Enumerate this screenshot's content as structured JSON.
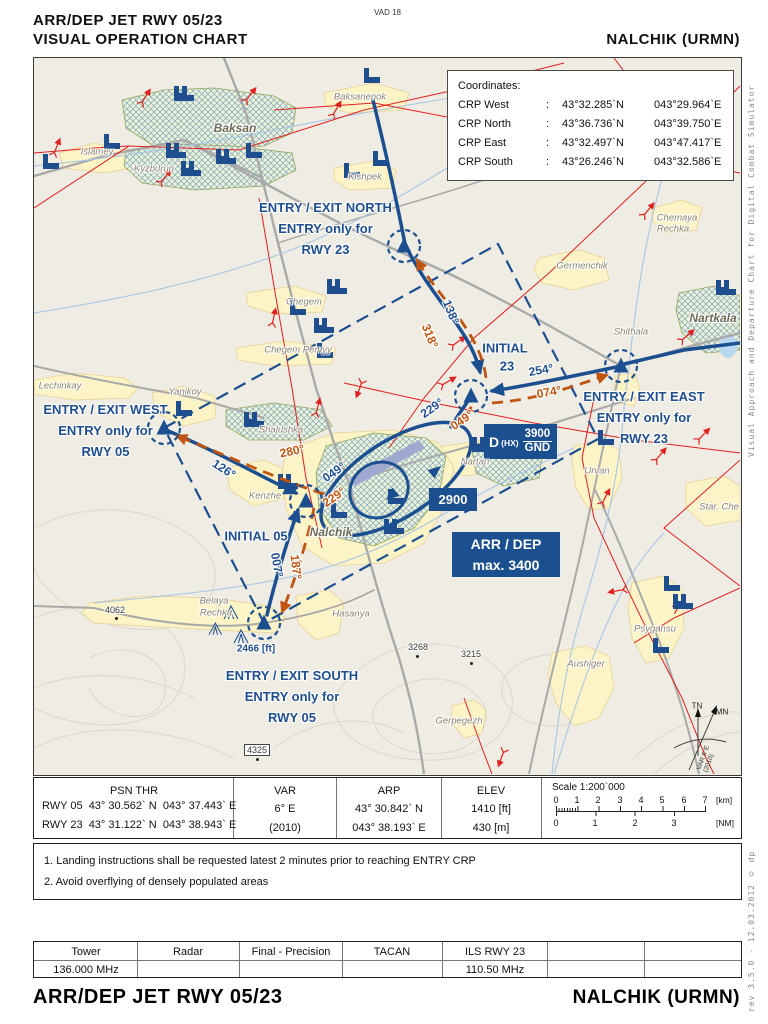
{
  "header": {
    "title": "ARR/DEP  JET  RWY  05/23",
    "subtitle": "VISUAL  OPERATION  CHART",
    "chart_code": "VAD 18",
    "airport": "NALCHIK (URMN)"
  },
  "footer": {
    "title": "ARR/DEP  JET  RWY  05/23",
    "airport": "NALCHIK (URMN)"
  },
  "margin": {
    "right_top": "Visual Approach and Departure Chart for Digital Combat Simulator",
    "right_bottom": "rev 3.5.0  -  12.03.2012 © dp"
  },
  "coordinates_box": {
    "title": "Coordinates:",
    "rows": [
      {
        "label": "CRP West",
        "sep": ":",
        "lat": "43°32.285`N",
        "lon": "043°29.964`E"
      },
      {
        "label": "CRP North",
        "sep": ":",
        "lat": "43°36.736`N",
        "lon": "043°39.750`E"
      },
      {
        "label": "CRP East",
        "sep": ":",
        "lat": "43°32.497`N",
        "lon": "043°47.417`E"
      },
      {
        "label": "CRP South",
        "sep": ":",
        "lat": "43°26.246`N",
        "lon": "043°32.586`E"
      }
    ]
  },
  "entry_labels": {
    "north": {
      "l1": "ENTRY / EXIT NORTH",
      "l2": "ENTRY only for",
      "l3": "RWY 23"
    },
    "east": {
      "l1": "ENTRY / EXIT EAST",
      "l2": "ENTRY only for",
      "l3": "RWY 23"
    },
    "west": {
      "l1": "ENTRY / EXIT WEST",
      "l2": "ENTRY only for",
      "l3": "RWY 05"
    },
    "south": {
      "l1": "ENTRY / EXIT SOUTH",
      "l2": "ENTRY only for",
      "l3": "RWY 05"
    },
    "initial23_l1": "INITIAL",
    "initial23_l2": "23",
    "initial05": "INITIAL 05"
  },
  "courses": {
    "c138": "138°",
    "c318": "318°",
    "c254": "254°",
    "c074": "074°",
    "c229": "229°",
    "c049": "049°",
    "c126": "126°",
    "c280": "280°",
    "c007": "007°",
    "c187": "187°"
  },
  "alt_boxes": {
    "danger_d": "D",
    "danger_hx": "(HX)",
    "danger_top": "3900",
    "danger_bottom": "GND",
    "circuit_alt": "2900",
    "arrdep_l1": "ARR / DEP",
    "arrdep_l2": "max. 3400"
  },
  "places": {
    "baksan": "Baksan",
    "islamey": "Islamey",
    "kyzburun": "Kyzburun",
    "baksanenok": "Baksanenok",
    "kishpek": "Kishpek",
    "chemaya_1": "Chemaya",
    "chemaya_2": "Rechka",
    "germenchik": "Germenchik",
    "nartkala": "Nartkala",
    "shithala": "Shithala",
    "chegem": "Chegem",
    "chegem_pervyy": "Chegem Pervyy",
    "lechinkay": "Lechinkay",
    "yanikoy": "Yanikoy",
    "shalushka": "Shalushka",
    "kenzhe": "Kenzhe",
    "nalchik": "Nalchik",
    "nartan": "Nartan",
    "urvan": "Urvan",
    "star_che": "Star. Che",
    "belaya_1": "Belaya",
    "belaya_2": "Rechka",
    "hasanya": "Hasanya",
    "psygansu": "Psygansu",
    "aushiger": "Aushiger",
    "gerpegezh": "Gerpegezh"
  },
  "spot_heights": {
    "s4062": "4062",
    "s3268": "3268",
    "s3215": "3215",
    "s4325": "4325",
    "crp_south_elev": "2466 [ft]"
  },
  "compass": {
    "tn": "TN",
    "mn": "MN",
    "var_l1": "VAR 6°E",
    "var_l2": "(2010)"
  },
  "info_table": {
    "psn": {
      "header": "PSN THR",
      "rows": [
        {
          "rwy": "RWY 05",
          "lat": "43° 30.562` N",
          "lon": "043° 37.443` E"
        },
        {
          "rwy": "RWY 23",
          "lat": "43° 31.122` N",
          "lon": "043° 38.943` E"
        }
      ]
    },
    "var": {
      "header": "VAR",
      "v1": "6° E",
      "v2": "(2010)"
    },
    "arp": {
      "header": "ARP",
      "v1": "43° 30.842`  N",
      "v2": "043° 38.193`  E"
    },
    "elev": {
      "header": "ELEV",
      "v1": "1410 [ft]",
      "v2": "430 [m]"
    },
    "scale": {
      "title": "Scale 1:200`000",
      "km_ticks": [
        "0",
        "1",
        "2",
        "3",
        "4",
        "5",
        "6",
        "7"
      ],
      "km_unit": "[km]",
      "nm_ticks": [
        "0",
        "1",
        "2",
        "3"
      ],
      "nm_unit": "[NM]"
    }
  },
  "notes": [
    "1. Landing instructions shall be requested latest 2 minutes prior to reaching ENTRY CRP",
    "2. Avoid overflying of densely populated areas"
  ],
  "freq_table": {
    "headers": [
      "Tower",
      "Radar",
      "Final - Precision",
      "TACAN",
      "ILS RWY 23",
      "",
      ""
    ],
    "values": [
      "136.000 MHz",
      "",
      "",
      "",
      "110.50 MHz",
      "",
      ""
    ]
  }
}
